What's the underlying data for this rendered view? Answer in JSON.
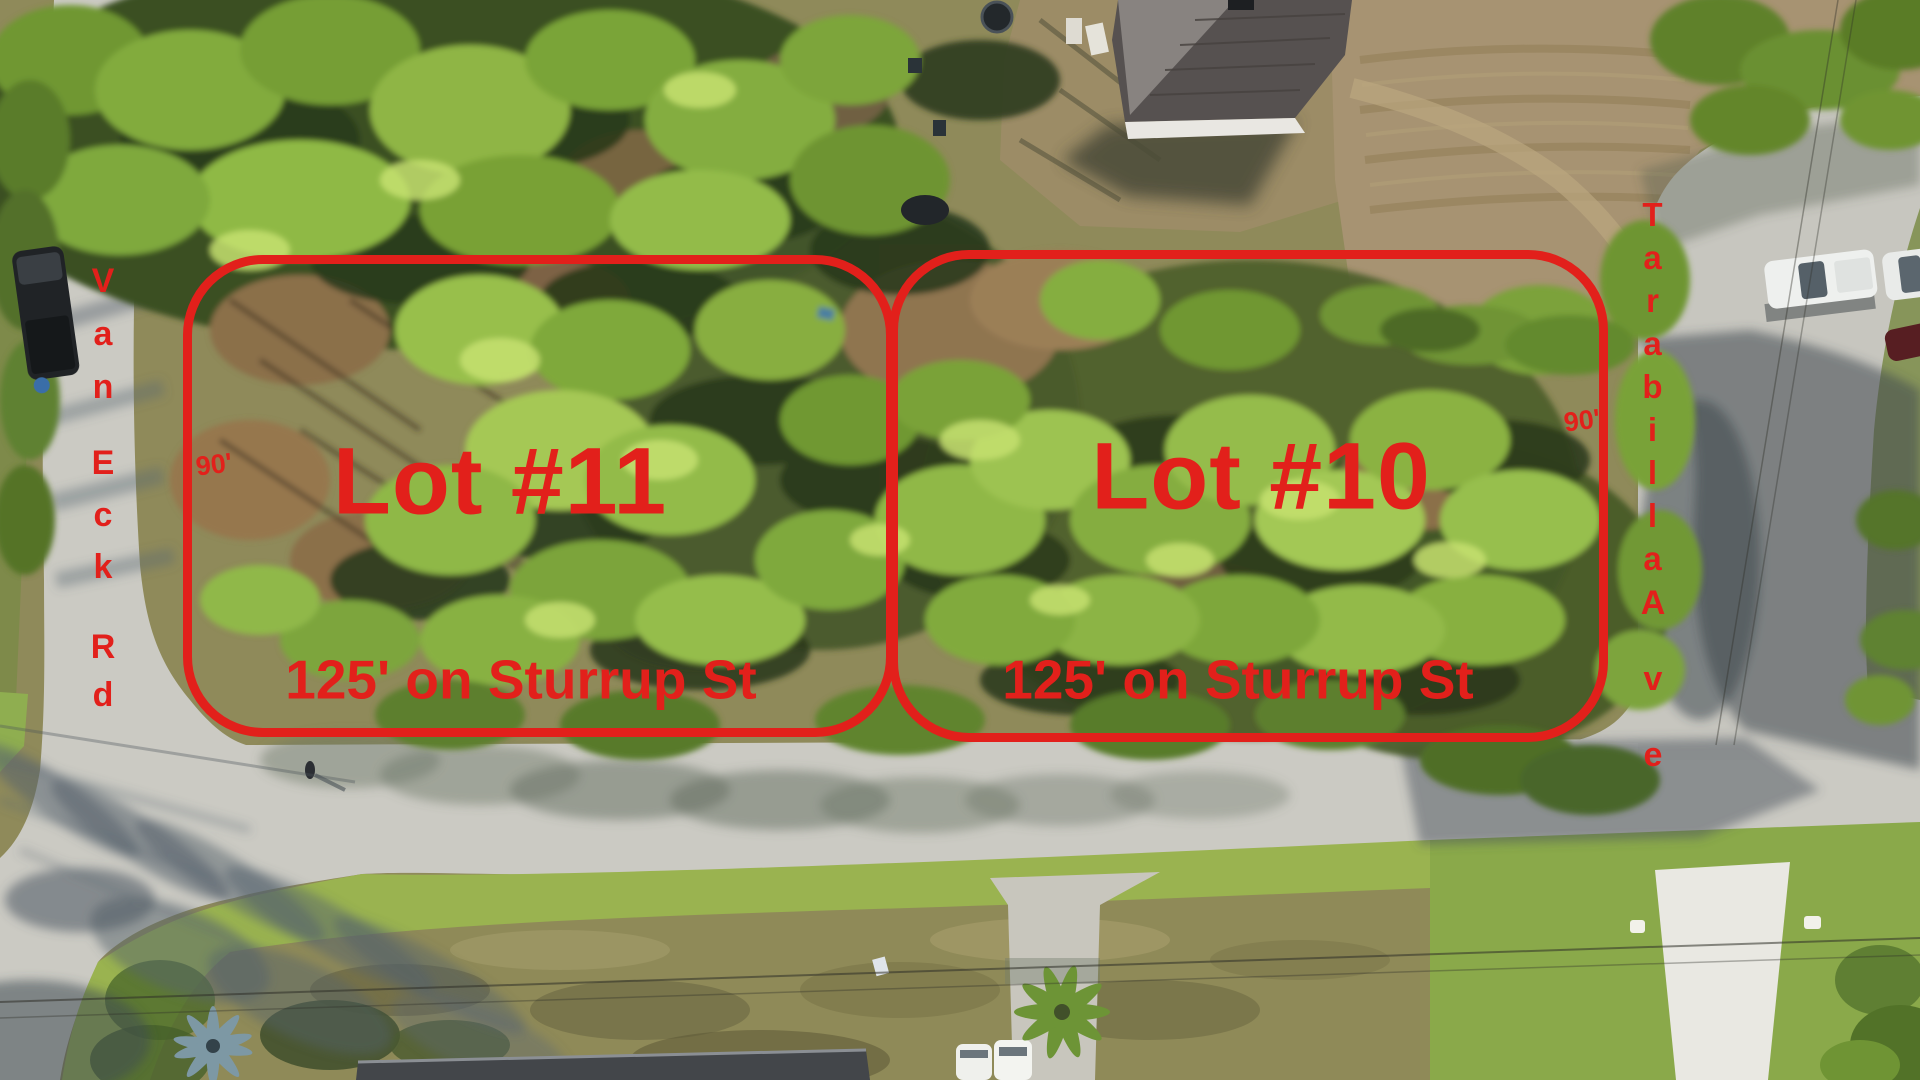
{
  "annotations": {
    "accent_color": "#e2201b",
    "lot_left": {
      "title": "Lot #11",
      "frontage": "125' on Sturrup St",
      "depth": "90'"
    },
    "lot_right": {
      "title": "Lot #10",
      "frontage": "125' on Sturrup St",
      "depth": "90'"
    },
    "street_left": {
      "name": "Van Eck Rd",
      "w1": "Van",
      "w2": "Eck",
      "w3": "Rd"
    },
    "street_right": {
      "name": "Tarabilla Ave",
      "w1": "Tarabilla",
      "w2": "Ave"
    }
  }
}
